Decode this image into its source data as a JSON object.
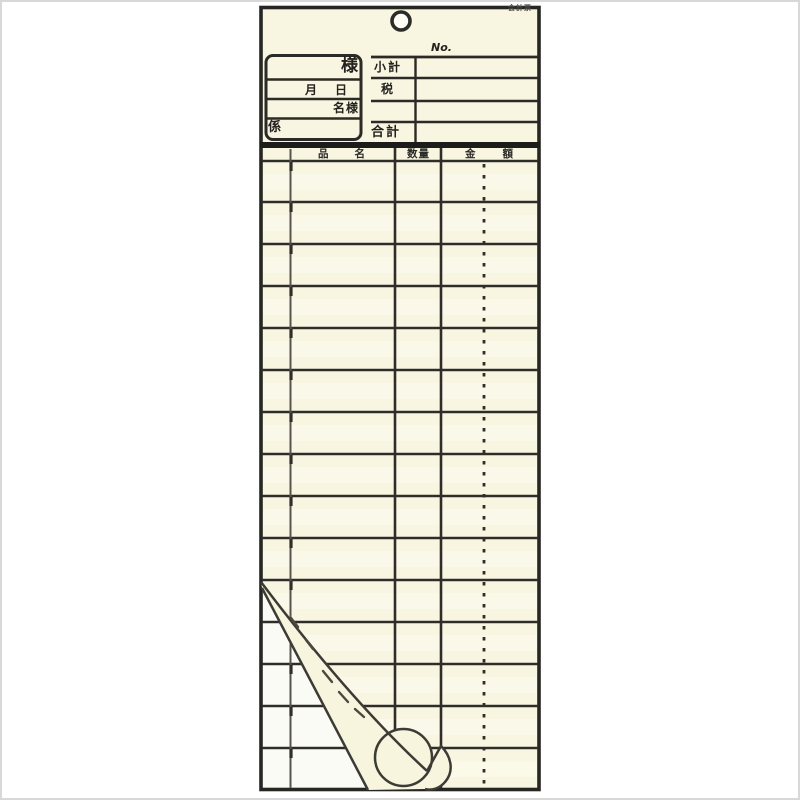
{
  "slip": {
    "code": "会計票",
    "header": {
      "customer_suffix": "様",
      "date_label": "月日",
      "guests_label": "名様",
      "server_label": "係",
      "no_label": "No.",
      "subtotal_label": "小計",
      "tax_label": "税",
      "total_label": "合計"
    },
    "table": {
      "columns": [
        {
          "label": "品名"
        },
        {
          "label": "数量"
        },
        {
          "label": "金額"
        }
      ],
      "row_count": 15
    },
    "colors": {
      "paper": "#f8f6e1",
      "copy_paper": "#fbfbf5",
      "line": "#2e2d29",
      "heavy_bar": "#1c1c1a",
      "background": "#ffffff",
      "frame": "#d8d8d8"
    }
  }
}
